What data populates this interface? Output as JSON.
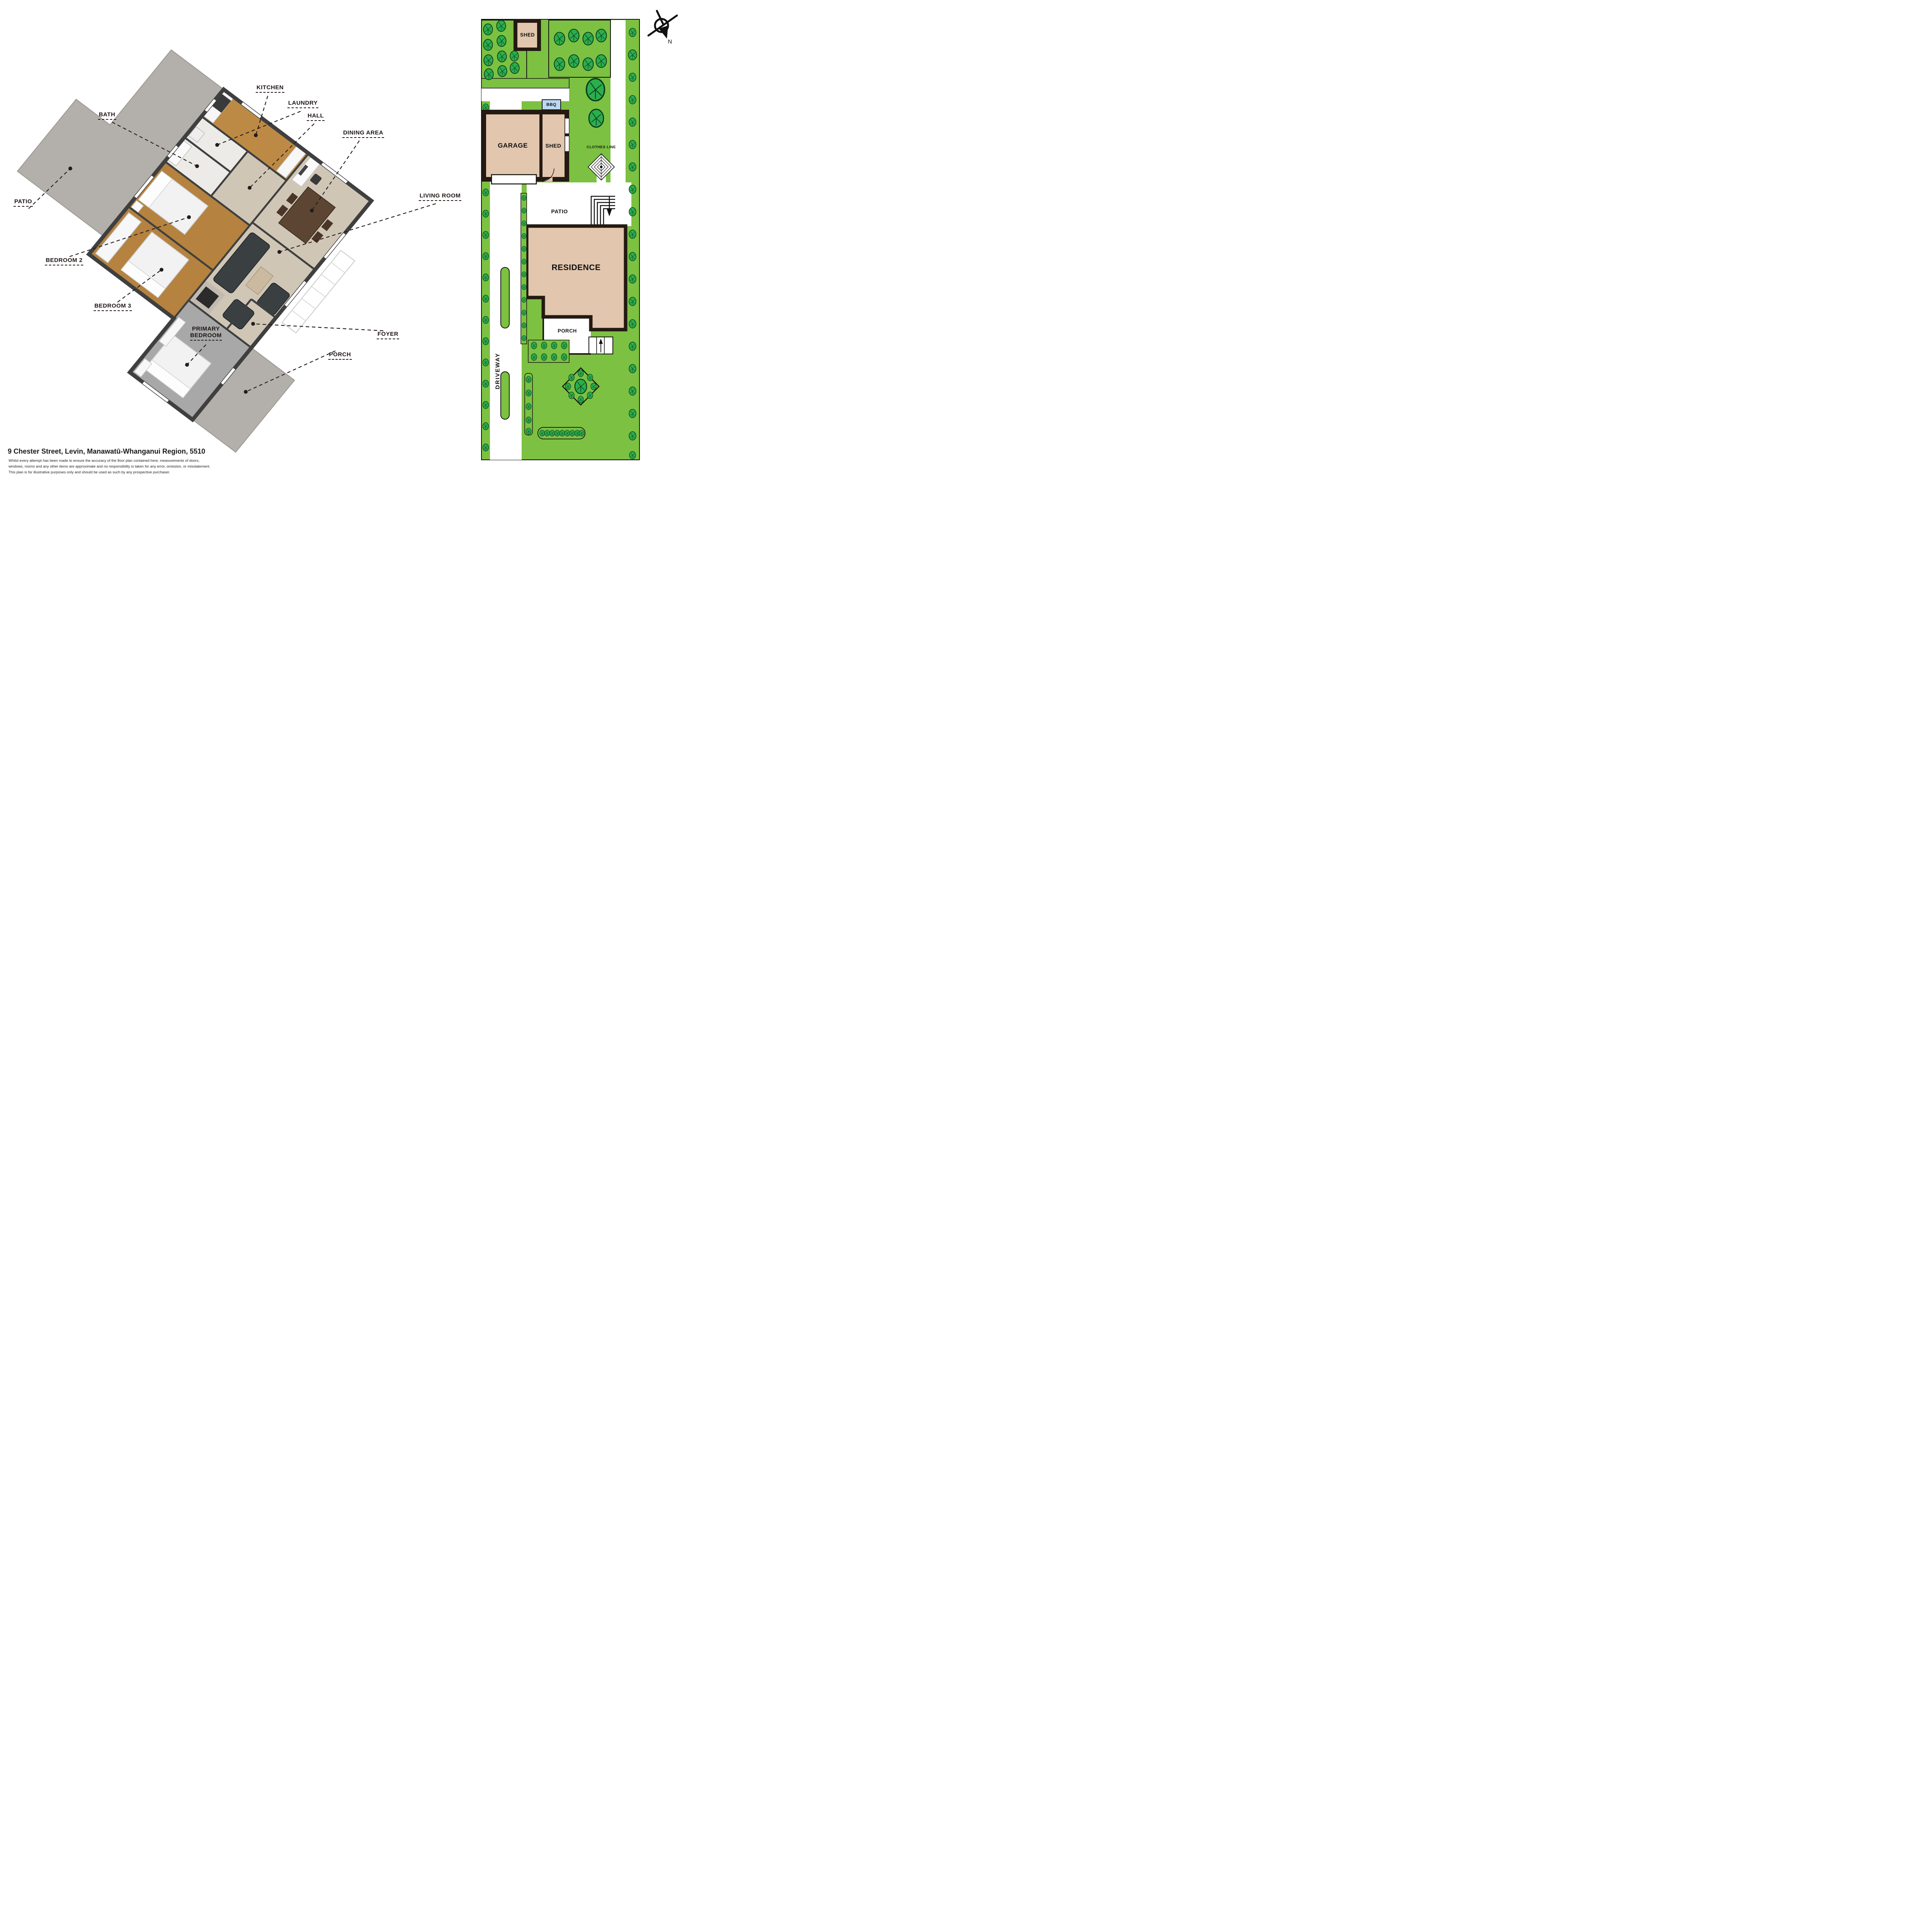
{
  "address": "9 Chester Street, Levin, Manawatū-Whanganui Region, 5510",
  "disclaimer_lines": [
    "Whilst every attempt has been made to ensure the accuracy of the floor plan contained here, measurements of doors,",
    "windows, rooms and any other items are approximate and no responsibility is taken for any error, omission, or misstatement.",
    "This plan is for illustrative purposes only and should be used as such by any prospective purchaser."
  ],
  "floor_plan": {
    "labels": {
      "kitchen": "KITCHEN",
      "laundry": "LAUNDRY",
      "hall": "HALL",
      "bath": "BATH",
      "dining_area": "DINING AREA",
      "living_room": "LIVING ROOM",
      "patio": "PATIO",
      "bedroom2": "BEDROOM 2",
      "bedroom3": "BEDROOM 3",
      "primary_line1": "PRIMARY",
      "primary_line2": "BEDROOM",
      "foyer": "FOYER",
      "porch": "PORCH"
    }
  },
  "site_plan": {
    "labels": {
      "shed_top": "SHED",
      "bbq": "BBQ",
      "garage": "GARAGE",
      "shed": "SHED",
      "clothes_line": "CLOTHES LINE",
      "patio": "PATIO",
      "residence": "RESIDENCE",
      "porch": "PORCH",
      "driveway": "DRIVEWAY"
    },
    "compass_north": "N"
  },
  "colors": {
    "lawn": "#7cc142",
    "tree": "#2bae4d",
    "building_fill": "#e2c6ae",
    "wall_dark": "#241a12",
    "concrete": "#b3b0ab",
    "bbq_blue": "#bcd8f0",
    "wood_floor": "#b5823f",
    "carpet_beige": "#cfc6b6",
    "carpet_gray": "#a8a8a8",
    "leader_line": "#241c1c"
  }
}
